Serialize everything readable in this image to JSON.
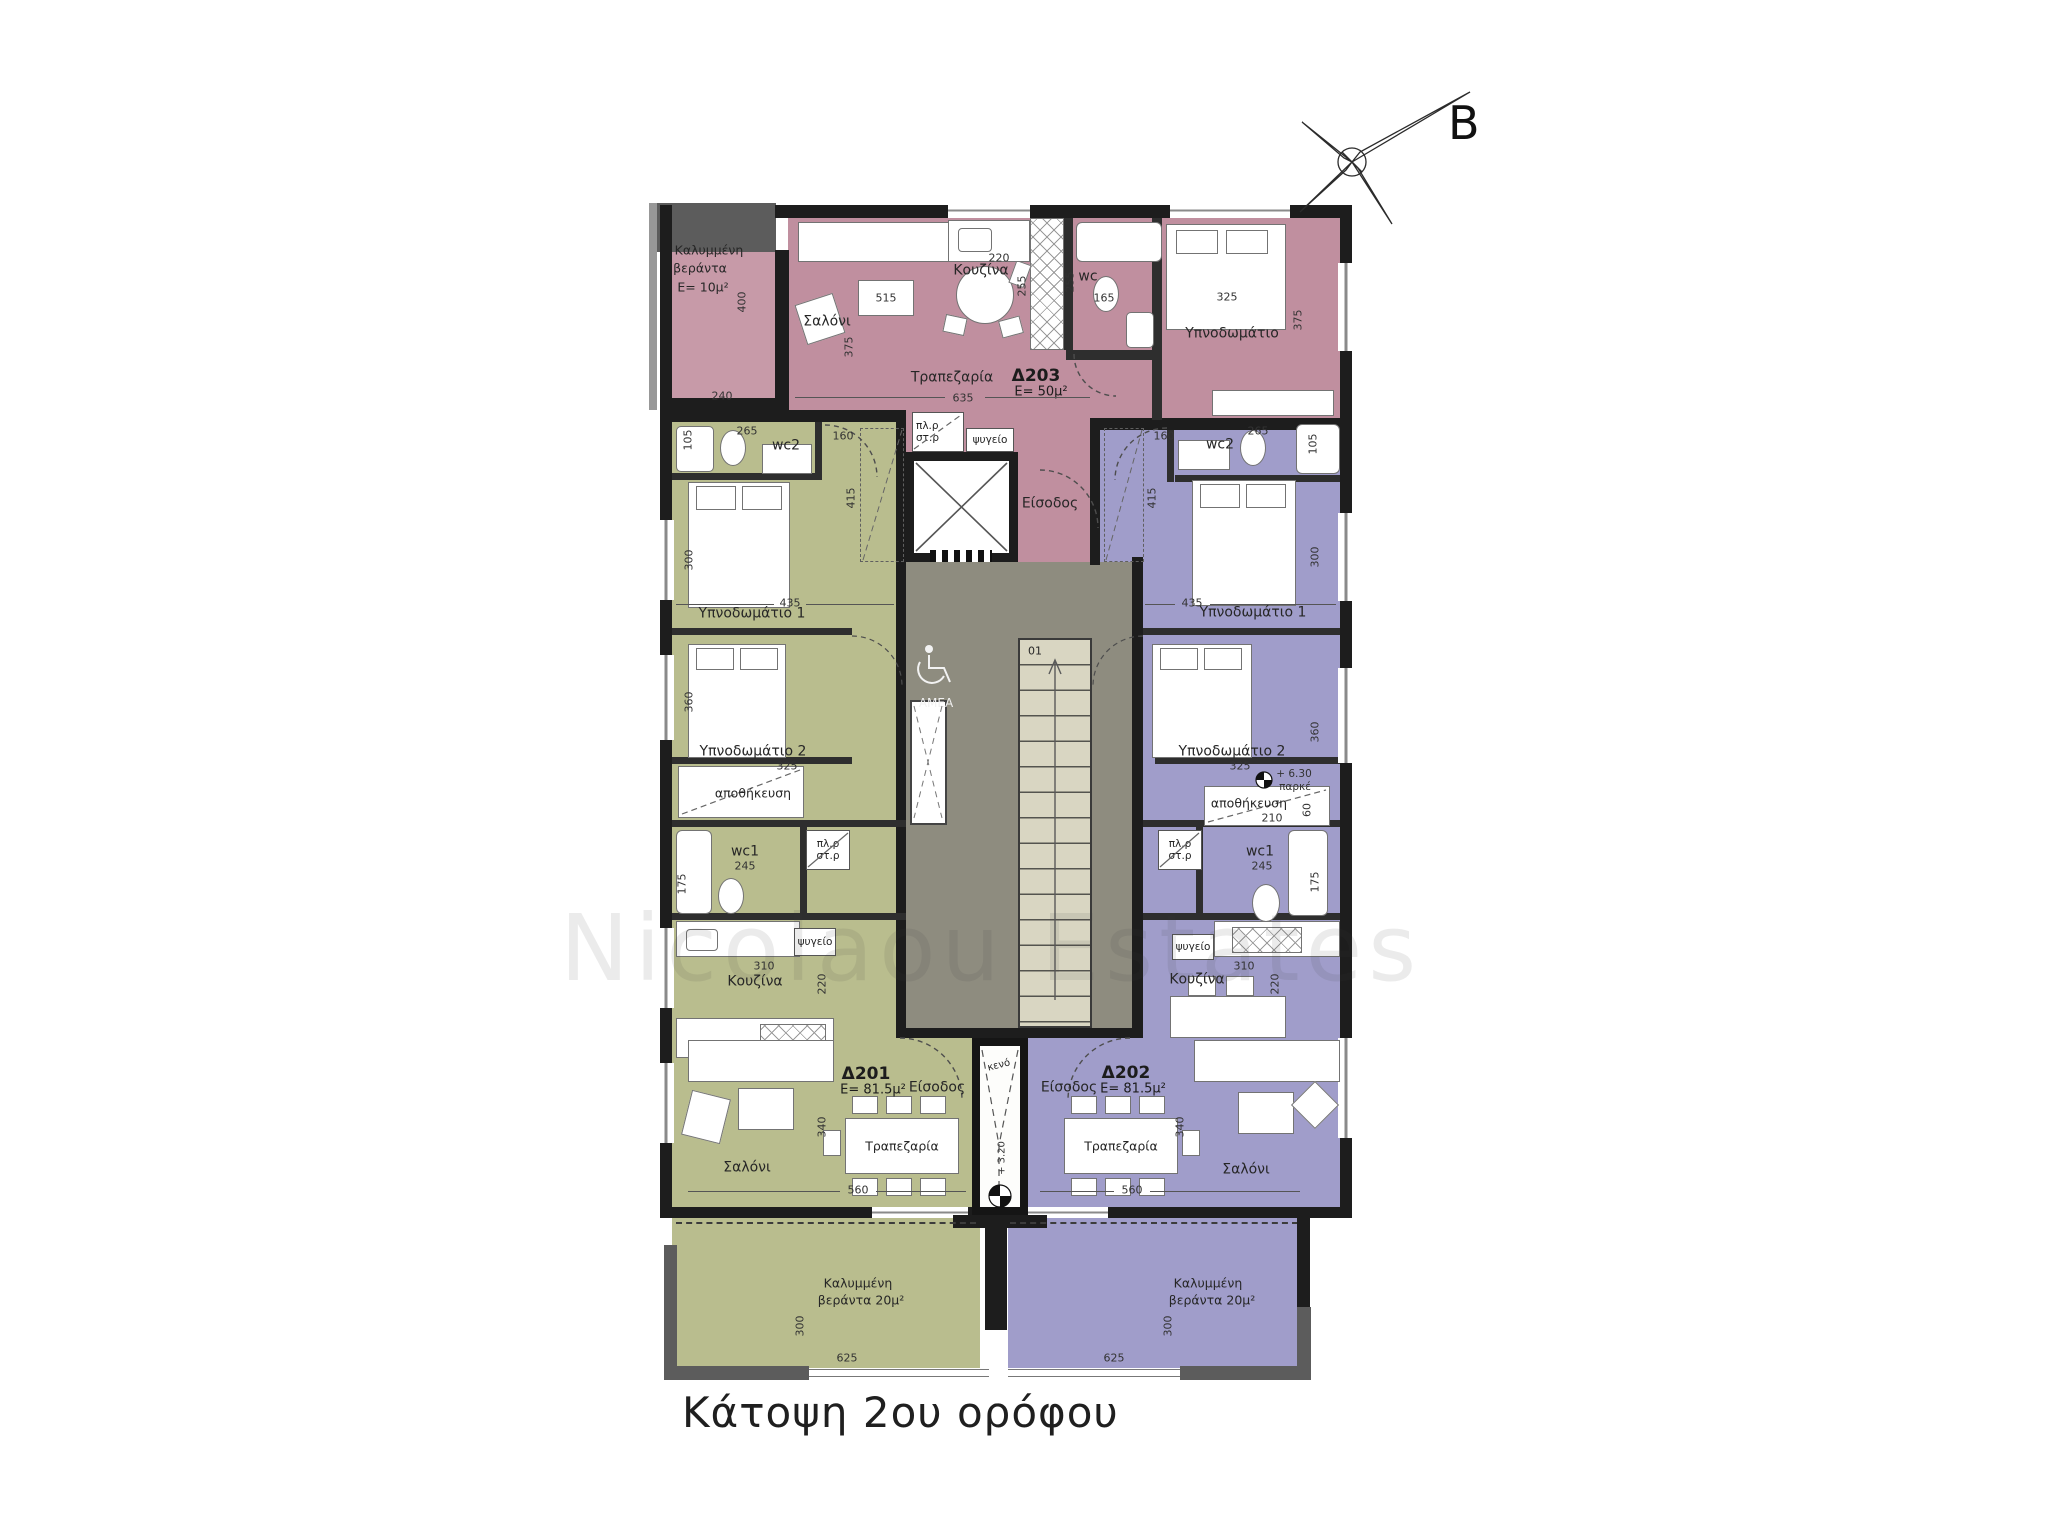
{
  "title": "Κάτοψη 2ου ορόφου",
  "compass": {
    "label": "B"
  },
  "watermark": "Nicolaou Estates",
  "colors": {
    "apartment_203": "#c08f9f",
    "apartment_201": "#b9bd8e",
    "apartment_202": "#a09dca",
    "core": "#8e8c7f",
    "stair": "#d9d6c2",
    "wall": "#1d1d1d"
  },
  "icons": {
    "north": "north-arrow-icon",
    "accessibility": "wheelchair-icon",
    "elevator": "elevator-x-icon",
    "level_marker": "level-quadrant-icon"
  },
  "core": {
    "stair_number": "01",
    "void": "κενό",
    "stair_level": "+ 3.20",
    "accessibility": "AMEA"
  },
  "apartments": {
    "d203": {
      "id": "Δ203",
      "area": "E= 50μ²",
      "veranda": {
        "line1": "Καλυμμένη",
        "line2": "βεράντα",
        "area": "E= 10μ²",
        "w": "240",
        "h": "400"
      },
      "rooms": {
        "living": "Σαλόνι",
        "kitchen": "Κουζίνα",
        "dining": "Τραπεζαρία",
        "wc": "wc",
        "bedroom": "Υπνοδωμάτιο",
        "entrance": "Είσοδος",
        "laundry1": "πλ.ρ",
        "laundry2": "στ.ρ",
        "fridge": "ψυγείο"
      },
      "dims": {
        "living_w": "515",
        "living_h": "375",
        "kitchen_w": "220",
        "kitchen_d": "255",
        "wc_d": "255",
        "wc_w": "165",
        "bedroom_w": "325",
        "bedroom_h": "375",
        "dining_w": "635"
      }
    },
    "d201": {
      "id": "Δ201",
      "area": "E= 81.5μ²",
      "rooms": {
        "wc2": "wc2",
        "bedroom1": "Υπνοδωμάτιο 1",
        "bedroom2": "Υπνοδωμάτιο 2",
        "storage": "αποθήκευση",
        "wc1": "wc1",
        "laundry1": "πλ.ρ",
        "laundry2": "στ.ρ",
        "fridge": "ψυγείο",
        "kitchen": "Κουζίνα",
        "living": "Σαλόνι",
        "dining": "Τραπεζαρία",
        "entrance": "Είσοδος"
      },
      "dims": {
        "wc2_w": "265",
        "wc2_h": "105",
        "hall_w": "160",
        "hall_h": "415",
        "bedroom1_h": "300",
        "bedroom1_w": "435",
        "bedroom2_h": "360",
        "bedroom2_w": "325",
        "wc1_w": "245",
        "wc1_h": "175",
        "kitchen_w": "310",
        "kitchen_h": "220",
        "living_h": "340",
        "living_w": "560"
      },
      "balcony": {
        "line1": "Καλυμμένη",
        "line2": "βεράντα 20μ²",
        "h": "300",
        "w": "625"
      }
    },
    "d202": {
      "id": "Δ202",
      "area": "E= 81.5μ²",
      "level": {
        "value": "+ 6.30",
        "label": "παρκέ"
      },
      "rooms": {
        "wc2": "wc2",
        "bedroom1": "Υπνοδωμάτιο 1",
        "bedroom2": "Υπνοδωμάτιο 2",
        "storage": "αποθήκευση",
        "wc1": "wc1",
        "laundry1": "πλ.ρ",
        "laundry2": "στ.ρ",
        "fridge": "ψυγείο",
        "kitchen": "Κουζίνα",
        "living": "Σαλόνι",
        "dining": "Τραπεζαρία",
        "entrance": "Είσοδος"
      },
      "dims": {
        "hall_w": "160",
        "wc2_w": "265",
        "wc2_h": "105",
        "hall_h": "415",
        "bedroom1_h": "300",
        "bedroom1_w": "435",
        "bedroom2_h": "360",
        "bedroom2_w": "325",
        "storage_w": "210",
        "storage_h": "60",
        "wc1_w": "245",
        "wc1_h": "175",
        "kitchen_w": "310",
        "kitchen_h": "220",
        "living_h": "340",
        "living_w": "560",
        "balcony_h": "300",
        "balcony_w": "625"
      },
      "balcony": {
        "line1": "Καλυμμένη",
        "line2": "βεράντα 20μ²",
        "h": "300",
        "w": "625"
      }
    }
  }
}
